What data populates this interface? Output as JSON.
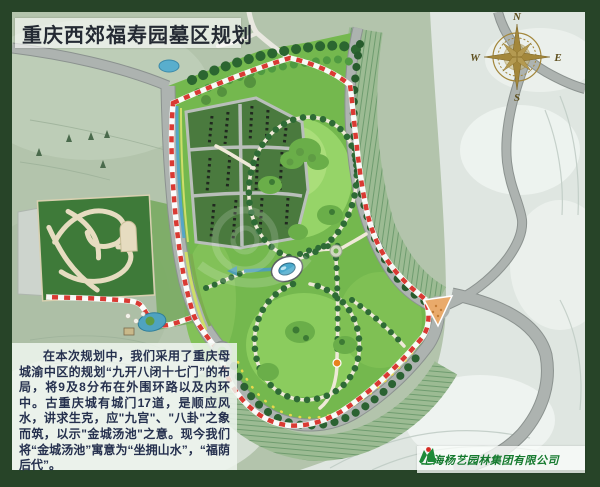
{
  "title": {
    "text": "重庆西郊福寿园墓区规划"
  },
  "compass": {
    "north": "N",
    "east": "E",
    "south": "S",
    "west": "W"
  },
  "description": {
    "paragraph": "在本次规划中，我们采用了重庆母城渝中区的规划“九开八闭十七门”的布局，将9及8分布在外围环路以及内环中。古重庆城有城门17道，是顺应风水，讲求生克，应\"九宫\"、\"八卦\"之象而筑，以示\"金城汤池\"之意。现今我们将“金城汤池”寓意为“坐拥山水”，“福荫后代”。"
  },
  "company": {
    "name": "上海杨艺园林集团有限公司"
  },
  "map_colors": {
    "frame_green": "#274428",
    "boundary_red": "#d93a33",
    "park_green": "#74b84e",
    "lawn_light_green": "#96d468",
    "plot_dark_green": "#4a7a3e",
    "water_blue": "#4aa9cb",
    "road_gray": "#adb3b0",
    "terrain_sage": "#b3c4ac",
    "terrain_pale": "#dfe6e1",
    "compass_gold": "#a3873b",
    "entry_island_orange": "#e9aa6b"
  }
}
